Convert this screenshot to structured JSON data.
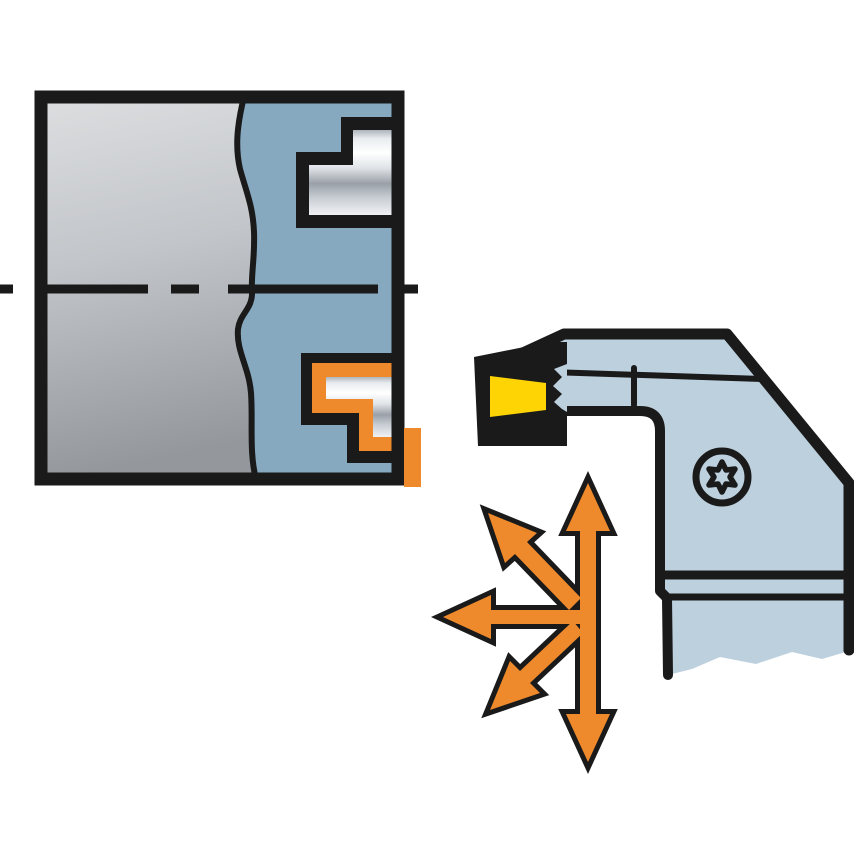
{
  "diagram": {
    "kind": "machining-application-illustration",
    "workpiece": {
      "label": "workpiece-cross-section",
      "break_line": "wavy-break-line",
      "centerline": "dashed-rotation-axis",
      "grooves": [
        "stepped-groove-upper",
        "stepped-groove-lower-highlighted"
      ],
      "highlight": "orange-machined-profile"
    },
    "tool": {
      "label": "grooving-turning-tool-holder",
      "insert": "cutting-insert",
      "screw": "torx-clamp-screw"
    },
    "arrows": {
      "label": "feed-direction-arrows",
      "directions": [
        "up",
        "down",
        "left",
        "upper-left",
        "lower-left"
      ]
    },
    "colors": {
      "background": "#FFFFFF",
      "ink": "#1A1A1A",
      "gray_top": "#DCDEE0",
      "gray_mid": "#C2C5C9",
      "gray_bottom": "#94979C",
      "machined_blue": "#86A9C0",
      "holder_blue": "#BDD0DE",
      "insert_yellow": "#FFD405",
      "orange": "#EE8A2B",
      "metal_stops": [
        "#AEB4BC",
        "#E9ECEF",
        "#FFFFFF",
        "#DFE3E7",
        "#9AA0A8",
        "#C9CED4",
        "#F0F2F4"
      ]
    }
  }
}
